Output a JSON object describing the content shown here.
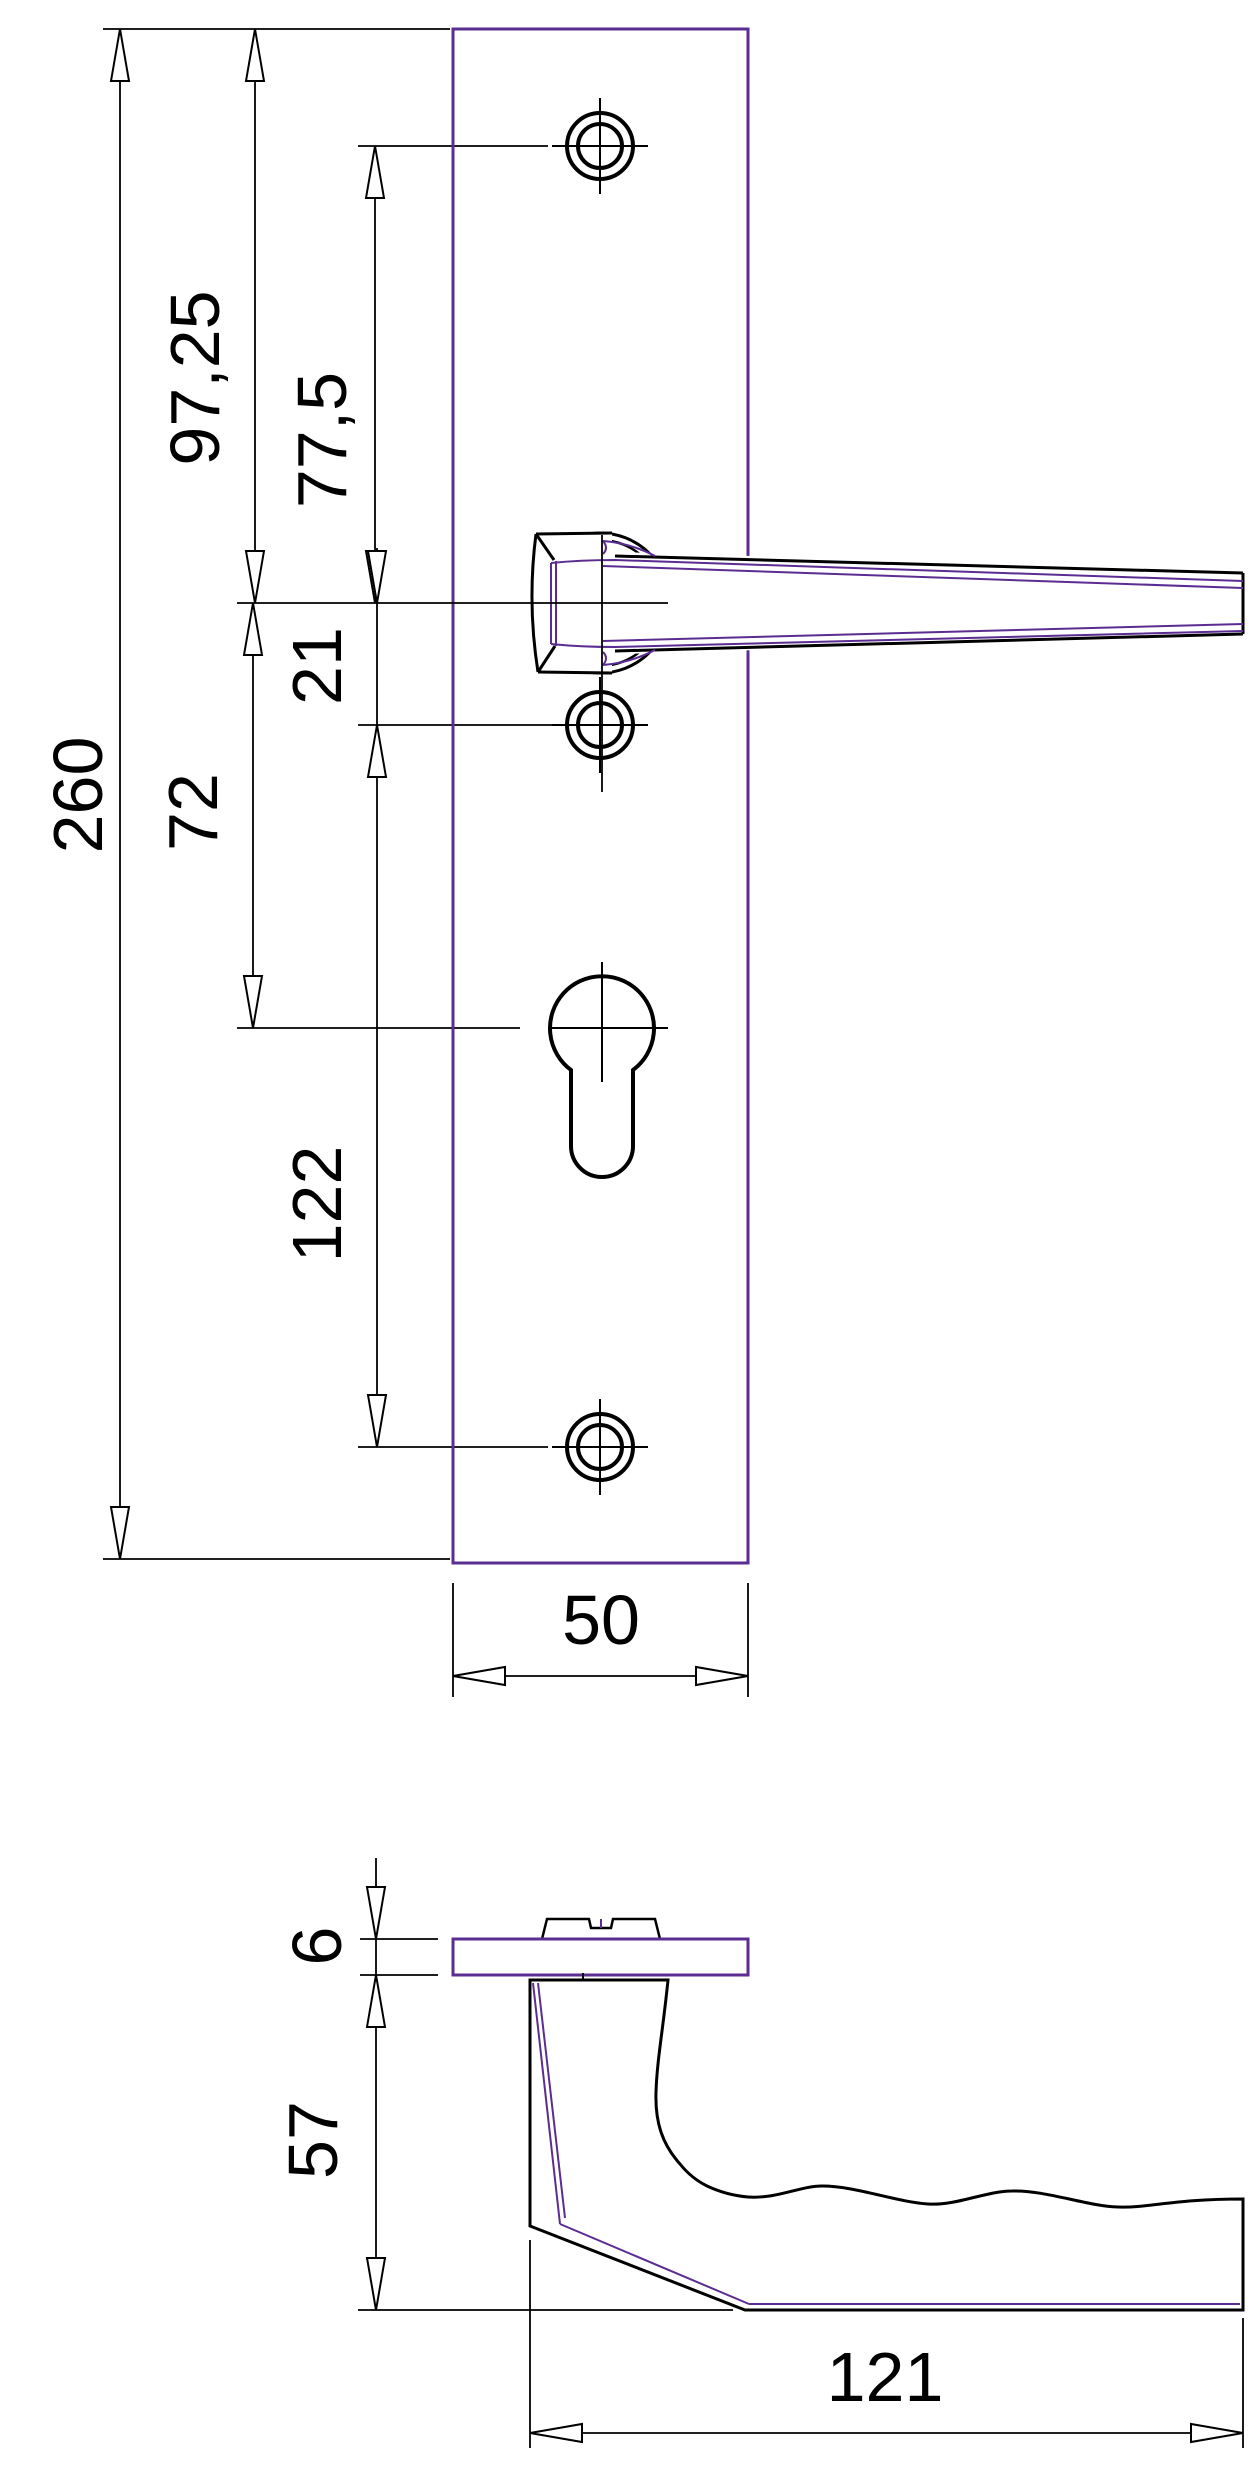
{
  "title": "Door handle with long backplate - dimensioned technical drawing",
  "colors": {
    "outline_violet": "#5b2c91",
    "line_black": "#000000",
    "background": "#ffffff"
  },
  "front_view": {
    "name": "front view of backplate with lever handle",
    "features": [
      "top screw hole",
      "lever handle with square rose",
      "middle screw hole",
      "euro cylinder keyhole",
      "bottom screw hole"
    ],
    "dimensions": {
      "overall_height": {
        "value": "260"
      },
      "plate_top_to_handle_axis": {
        "value": "97,25"
      },
      "top_screw_to_handle_axis": {
        "value": "77,5"
      },
      "handle_axis_to_mid_screw": {
        "value": "21"
      },
      "handle_axis_to_cylinder": {
        "value": "72"
      },
      "mid_screw_to_bottom_screw": {
        "value": "122"
      },
      "plate_width": {
        "value": "50"
      }
    }
  },
  "side_view": {
    "name": "side profile of plate and handle",
    "features": [
      "plate cross-section",
      "spindle collar",
      "handle neck",
      "gripped lever with finger scallops"
    ],
    "dimensions": {
      "plate_thickness": {
        "value": "6"
      },
      "handle_projection": {
        "value": "57"
      },
      "handle_length": {
        "value": "121"
      }
    }
  }
}
